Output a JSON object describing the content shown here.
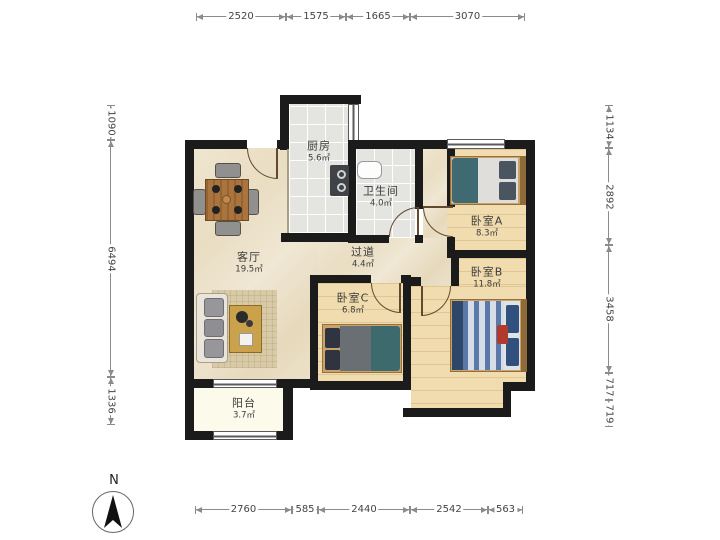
{
  "plan": {
    "compass_label": "N",
    "rooms": [
      {
        "name": "厨房",
        "area": "5.6㎡"
      },
      {
        "name": "卫生间",
        "area": "4.0㎡"
      },
      {
        "name": "客厅",
        "area": "19.5㎡"
      },
      {
        "name": "过道",
        "area": "4.4㎡"
      },
      {
        "name": "卧室A",
        "area": "8.3㎡"
      },
      {
        "name": "卧室B",
        "area": "11.8㎡"
      },
      {
        "name": "卧室C",
        "area": "6.8㎡"
      },
      {
        "name": "阳台",
        "area": "3.7㎡"
      }
    ],
    "dimensions": {
      "top": [
        "2520",
        "1575",
        "1665",
        "3070"
      ],
      "bottom": [
        "2760",
        "585",
        "2440",
        "2542",
        "563"
      ],
      "left": [
        "1090",
        "6494",
        "1336"
      ],
      "right": [
        "1134",
        "2892",
        "3458",
        "717",
        "719"
      ]
    },
    "colors": {
      "wall": "#1b1b1b",
      "marble_floor": "#ece1c9",
      "wood_floor": "#f0dcae",
      "tile_floor": "#e4e4e1",
      "balcony_floor": "#fcfaeb",
      "accent_teal": "#3f6a72",
      "accent_navy": "#31507e",
      "accent_red": "#b03a2e",
      "table_wood": "#a9743d"
    }
  }
}
